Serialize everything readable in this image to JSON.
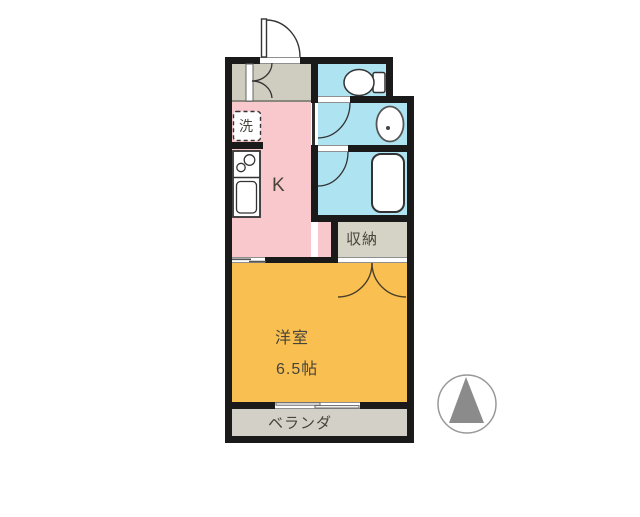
{
  "colors": {
    "wall": "#1a1a1a",
    "entry": "#cfccc0",
    "storage": "#d5d2c6",
    "balcony": "#d3d0c8",
    "kitchen": "#f9c8cc",
    "water": "#aee3f2",
    "room": "#f9c051",
    "text": "#46443b",
    "compass": "#8b8b8b"
  },
  "labels": {
    "kitchen": "K",
    "washer": "洗",
    "storage": "収納",
    "room_name": "洋室",
    "room_size": "6.5帖",
    "balcony": "ベランダ"
  },
  "icons": {
    "compass": "north-arrow",
    "fixtures": [
      "entrance-door",
      "entry-closet-double-door",
      "toilet",
      "washbasin",
      "bathtub",
      "stove-sink-counter",
      "washing-machine-space",
      "closet-double-door",
      "sliding-window"
    ]
  }
}
